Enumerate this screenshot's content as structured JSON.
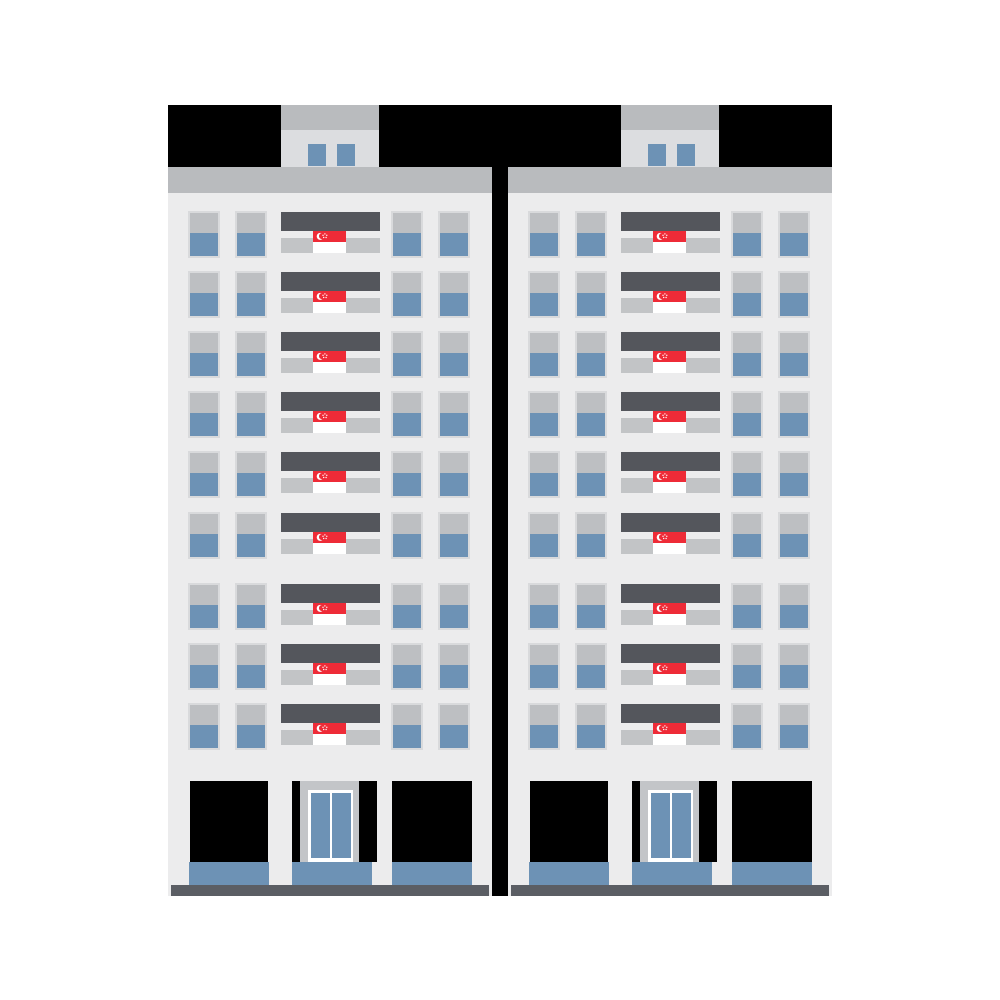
{
  "scene": {
    "description": "Flat vector illustration of two identical high-rise HDB-style apartment blocks separated by a dark gap, every balcony decorated with a Singapore flag",
    "background": "#ffffff"
  },
  "counts": {
    "buildings": 2,
    "floors_per_building": 9,
    "windows_per_floor": 4,
    "flags_per_building": 9,
    "penthouse_windows_per_building": 2,
    "void_deck_openings_per_building": 3
  },
  "colors": {
    "background": "#ffffff",
    "black": "#000000",
    "band_gray": "#b9bbbe",
    "penthouse_body": "#dcdde0",
    "facade": "#ececed",
    "window_frame": "#d9dadc",
    "window_gray": "#bdbfc2",
    "window_blue": "#6d92b5",
    "balcony_slab": "#54565c",
    "balcony_ledge": "#c2c4c6",
    "flag_red": "#ee2b37",
    "flag_white": "#ffffff",
    "door_frame_gray": "#c3c5c8",
    "door_white": "#ffffff",
    "ground_bar": "#5b5e64"
  },
  "layout": {
    "buildings_x": [
      168,
      508
    ],
    "gap_column": {
      "x": 492,
      "y": 105,
      "w": 16,
      "h": 791
    },
    "building": {
      "top": 105,
      "width": 324,
      "height": 791,
      "roof_blocks": [
        {
          "x": 0,
          "y": 0,
          "w": 113,
          "h": 62
        },
        {
          "x": 211,
          "y": 0,
          "w": 113,
          "h": 62
        }
      ],
      "penthouse": {
        "cap": {
          "x": 113,
          "y": 0,
          "w": 98,
          "h": 25
        },
        "body": {
          "x": 113,
          "y": 25,
          "w": 98,
          "h": 37
        },
        "windows": [
          {
            "x": 140,
            "y": 39,
            "w": 18,
            "h": 22
          },
          {
            "x": 169,
            "y": 39,
            "w": 18,
            "h": 22
          }
        ]
      },
      "band": {
        "x": 0,
        "y": 62,
        "w": 324,
        "h": 26
      },
      "facade": {
        "x": 0,
        "y": 88,
        "w": 324,
        "h": 703
      },
      "floors": {
        "tops": [
          106,
          166,
          226,
          286,
          346,
          407,
          478,
          538,
          598
        ],
        "row_h": 47,
        "windows_x": [
          20,
          67,
          223,
          270
        ],
        "window_w": 32,
        "window_gray_h": 20,
        "balcony": {
          "x": 113,
          "w": 99,
          "slab_dy": 1,
          "slab_h": 19,
          "ledge_dy": 27,
          "ledge_h": 15
        },
        "flag": {
          "x": 145,
          "dy": 20,
          "w": 33,
          "h": 22
        }
      },
      "ground": {
        "openings": [
          {
            "x": 22,
            "w": 78
          },
          {
            "x": 124,
            "w": 85
          },
          {
            "x": 224,
            "w": 80
          }
        ],
        "opening_y": 676,
        "opening_h": 81,
        "steps": [
          {
            "x": 21,
            "w": 80
          },
          {
            "x": 124,
            "w": 80
          },
          {
            "x": 224,
            "w": 80
          }
        ],
        "step_y": 757,
        "step_h": 23,
        "door": {
          "frame": {
            "x": 132,
            "y": 676,
            "w": 59,
            "h": 81
          },
          "white": {
            "x": 140,
            "y": 685,
            "w": 45,
            "h": 72
          },
          "panels": [
            {
              "x": 3,
              "y": 3,
              "w": 19,
              "h": 65
            },
            {
              "x": 24,
              "y": 3,
              "w": 19,
              "h": 65
            }
          ]
        },
        "bar": {
          "x": 3,
          "y": 780,
          "w": 318,
          "h": 11
        }
      }
    }
  }
}
